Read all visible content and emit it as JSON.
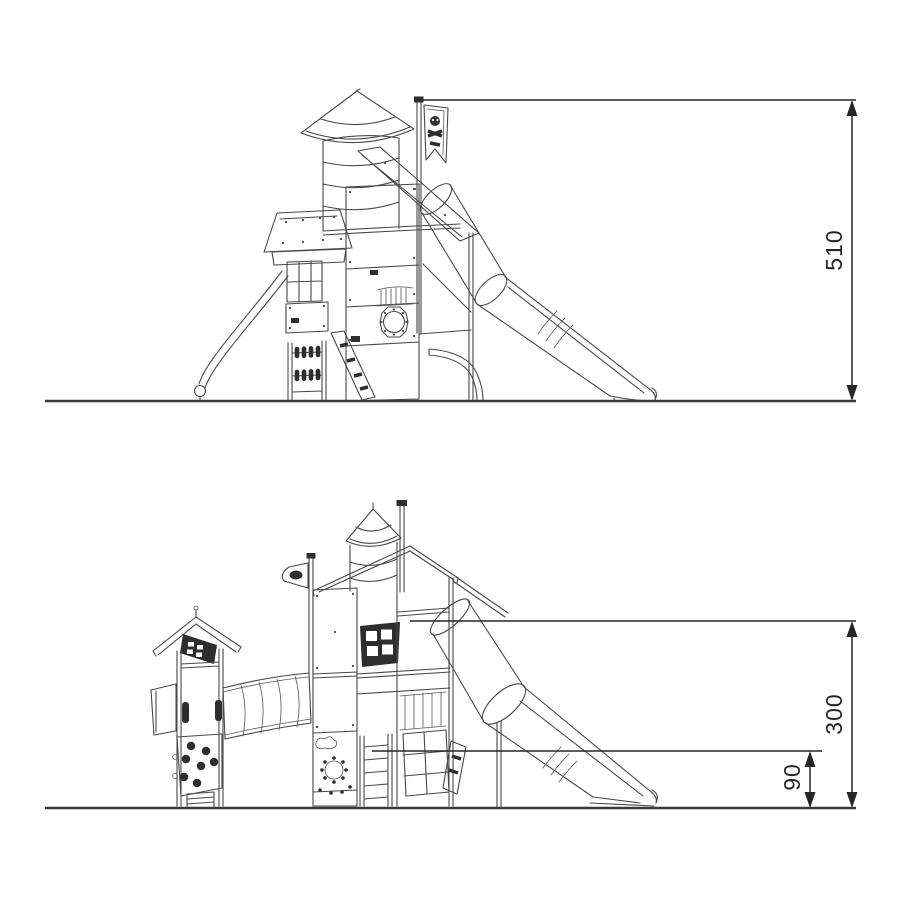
{
  "drawing": {
    "background": "#ffffff",
    "line_color": "#484848",
    "dimension_color": "#262626",
    "upper_view": {
      "dimensions": {
        "height_label": "510"
      }
    },
    "lower_view": {
      "dimensions": {
        "height_label": "300",
        "platform_label": "90"
      }
    }
  }
}
